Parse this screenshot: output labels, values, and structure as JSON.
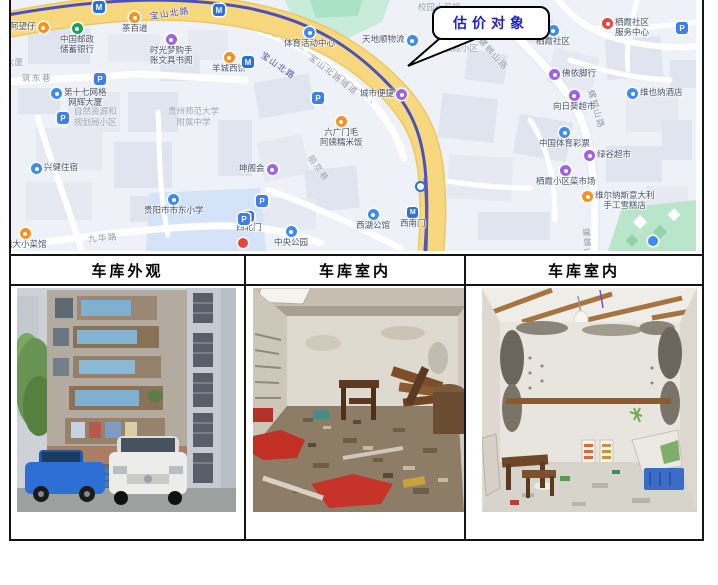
{
  "callout": {
    "label": "估价对象"
  },
  "table": {
    "headers": [
      "车库外观",
      "车库室内",
      "车库室内"
    ]
  },
  "map": {
    "icon_colors": {
      "orange": "#ff8f1f",
      "blue": "#3f8cee",
      "purple": "#9d62e5",
      "green": "#18a058",
      "red": "#e8463c",
      "metro": "#2c6de8",
      "parking": "#3f7df0"
    },
    "road_labels": [
      {
        "text": "宝山北路",
        "x": 140,
        "y": 10,
        "rot": -8,
        "c": "#3d4aa8"
      },
      {
        "text": "宝山北路",
        "x": 252,
        "y": 48,
        "rot": 35,
        "c": "#3d4aa8"
      },
      {
        "text": "宝山北路隧道",
        "x": 300,
        "y": 50,
        "rot": 38,
        "c": "#8d96a8"
      },
      {
        "text": "螺蛳山路",
        "x": 470,
        "y": 33,
        "rot": 48,
        "c": "#8d96a8"
      },
      {
        "text": "螺蛳山路",
        "x": 581,
        "y": 84,
        "rot": 74,
        "c": "#8d96a8"
      },
      {
        "text": "螺蛳山",
        "x": 576,
        "y": 222,
        "rot": 86,
        "c": "#8d96a8"
      },
      {
        "text": "丽京巷",
        "x": 300,
        "y": 150,
        "rot": 55,
        "c": "#8d96a8"
      },
      {
        "text": "筑东巷",
        "x": 12,
        "y": 72,
        "rot": 0,
        "c": "#8d96a8"
      },
      {
        "text": "九华路",
        "x": 78,
        "y": 233,
        "rot": -5,
        "c": "#8d96a8"
      }
    ],
    "area_labels": [
      {
        "text": "自然资源和\n规划局小区",
        "x": 64,
        "y": 106
      },
      {
        "text": "贵州师范大学\n附属中学",
        "x": 158,
        "y": 106
      },
      {
        "text": "校园小菜馆",
        "x": 408,
        "y": 2
      },
      {
        "text": "栖霞小区",
        "x": 434,
        "y": 43
      },
      {
        "text": "大厦",
        "x": -4,
        "y": 57
      }
    ],
    "pois": [
      {
        "label": "阿望仔",
        "type": "orange",
        "side": "ir",
        "x": 0,
        "y": 22
      },
      {
        "label": "茶百道",
        "type": "orange",
        "side": "it",
        "x": 112,
        "y": 12
      },
      {
        "label": "中国邮政\n储蓄银行",
        "type": "green",
        "side": "it",
        "x": 50,
        "y": 23
      },
      {
        "label": "时光梦购手\n账文具书阁",
        "type": "purple",
        "side": "it",
        "x": 140,
        "y": 34
      },
      {
        "label": "羊城西饼",
        "type": "orange",
        "side": "it",
        "x": 202,
        "y": 52
      },
      {
        "label": "第十七网格\n网辉大厦",
        "type": "blue",
        "side": "il",
        "x": 41,
        "y": 88
      },
      {
        "label": "兴健住宿",
        "type": "blue",
        "side": "il",
        "x": 21,
        "y": 163
      },
      {
        "label": "电大小菜馆",
        "type": "orange",
        "side": "it",
        "x": -6,
        "y": 228
      },
      {
        "label": "贵阳市市东小学",
        "type": "blue",
        "side": "it",
        "x": 134,
        "y": 194
      },
      {
        "label": "西北门",
        "type": "metro",
        "side": "it",
        "x": 226,
        "y": 211
      },
      {
        "label": "中央公园",
        "type": "blue",
        "side": "it",
        "x": 264,
        "y": 226
      },
      {
        "label": "坤阁会",
        "type": "purple",
        "side": "ir",
        "x": 229,
        "y": 164
      },
      {
        "label": "六广门毛\n阿姨糯米饭",
        "type": "orange",
        "side": "it",
        "x": 310,
        "y": 116
      },
      {
        "label": "西湖公馆",
        "type": "blue",
        "side": "it",
        "x": 346,
        "y": 209
      },
      {
        "label": "西南门",
        "type": "metro",
        "side": "it",
        "x": 390,
        "y": 207
      },
      {
        "label": "体育活动中心",
        "type": "blue",
        "side": "it",
        "x": 274,
        "y": 27
      },
      {
        "label": "天地顺物流",
        "type": "blue",
        "side": "ir",
        "x": 352,
        "y": 35
      },
      {
        "label": "城市便捷",
        "type": "purple",
        "side": "ir",
        "x": 350,
        "y": 89
      },
      {
        "label": "栖霞社区",
        "type": "blue",
        "side": "it",
        "x": 526,
        "y": 25
      },
      {
        "label": "栖霞社区\n服务中心",
        "type": "red",
        "side": "il",
        "x": 592,
        "y": 18
      },
      {
        "label": "佛依脚行",
        "type": "purple",
        "side": "il",
        "x": 539,
        "y": 69
      },
      {
        "label": "向日葵超市",
        "type": "purple",
        "side": "it",
        "x": 543,
        "y": 90
      },
      {
        "label": "中国体育彩票",
        "type": "blue",
        "side": "it",
        "x": 529,
        "y": 127
      },
      {
        "label": "绿谷超市",
        "type": "purple",
        "side": "il",
        "x": 574,
        "y": 150
      },
      {
        "label": "栖霞小区菜市场",
        "type": "purple",
        "side": "it",
        "x": 526,
        "y": 165
      },
      {
        "label": "维尔纳斯意大利\n手工雪糕店",
        "type": "orange",
        "side": "il",
        "x": 572,
        "y": 191
      },
      {
        "label": "维也纳酒店",
        "type": "blue",
        "side": "il",
        "x": 617,
        "y": 88
      }
    ],
    "markers": [
      {
        "type": "parking",
        "x": 84,
        "y": 73
      },
      {
        "type": "parking",
        "x": 47,
        "y": 112
      },
      {
        "type": "parking",
        "x": 302,
        "y": 92
      },
      {
        "type": "parking",
        "x": 246,
        "y": 195
      },
      {
        "type": "parking",
        "x": 228,
        "y": 213
      },
      {
        "type": "parking",
        "x": 666,
        "y": 22
      },
      {
        "type": "metro",
        "x": 83,
        "y": 1
      },
      {
        "type": "metro",
        "x": 203,
        "y": 4
      },
      {
        "type": "metro",
        "x": 232,
        "y": 56
      },
      {
        "type": "station",
        "x": 405,
        "y": 181
      },
      {
        "type": "red",
        "x": 228,
        "y": 238
      },
      {
        "type": "blue",
        "x": 638,
        "y": 236
      }
    ]
  }
}
